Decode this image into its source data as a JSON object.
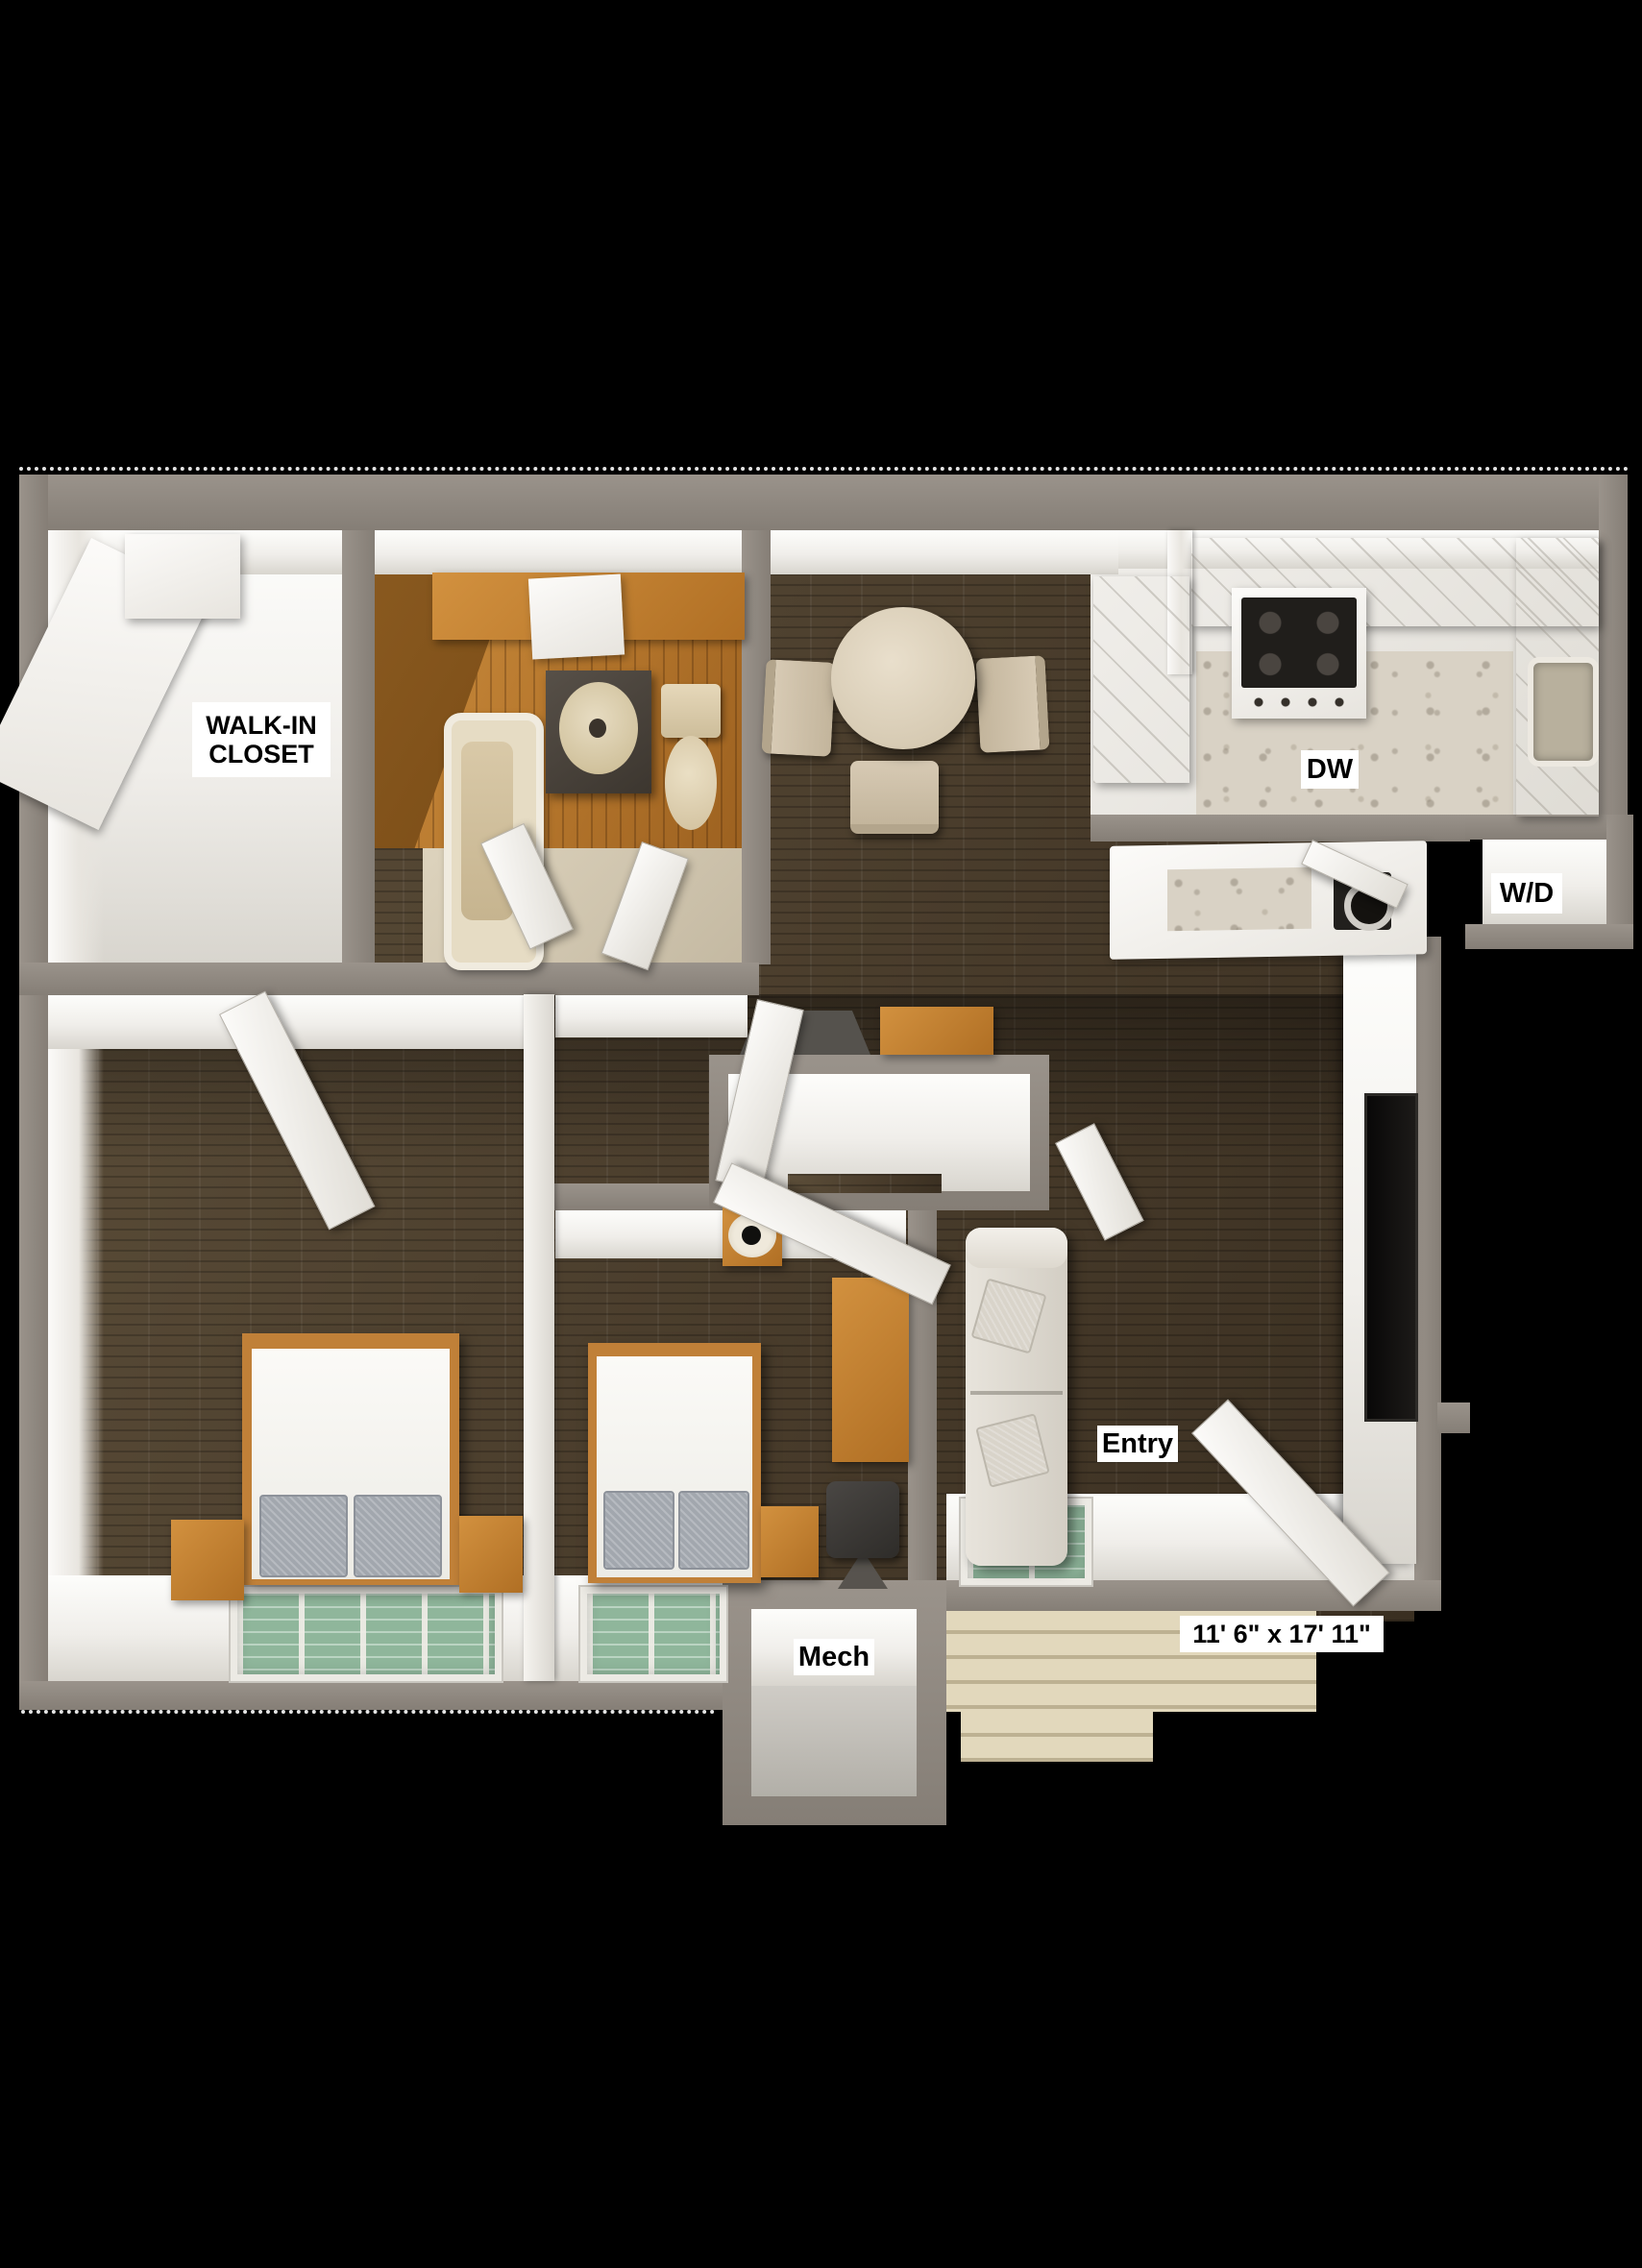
{
  "scene": {
    "type": "3d-floor-plan-top-view",
    "description": "One-bedroom-style apartment 3D floor plan render on black background",
    "background": "#000000"
  },
  "palette": {
    "wall_gray": "#8e8780",
    "wall_face_white": "#f0eeea",
    "floor_wood_brown": "#4e4130",
    "floor_bathroom_orange": "#b5762c",
    "floor_porch_beige": "#dbd1b4",
    "floor_kitchen_white": "#eceae5",
    "window_green": "#8fb69b",
    "furniture_wood_orange": "#c07a2e",
    "fixture_beige": "#d9c9a8",
    "appliance_dark": "#22201d",
    "label_background": "#ffffff",
    "label_text": "#000000"
  },
  "labels": {
    "walk_in_closet": {
      "line1": "WALK-IN",
      "line2": "CLOSET"
    },
    "dishwasher": "DW",
    "washer_dryer": "W/D",
    "entry": "Entry",
    "mechanical": "Mech",
    "living_room_dimensions": "11' 6\" x 17' 11\""
  }
}
